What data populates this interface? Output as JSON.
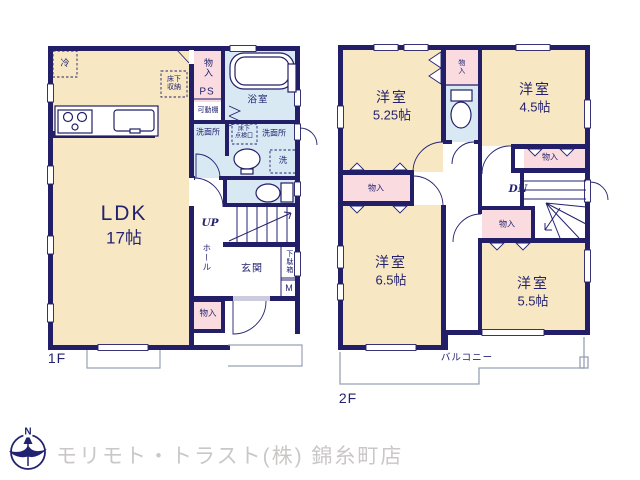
{
  "floor1": {
    "name": "1F",
    "ldk": "LDK",
    "ldk_size": "17帖",
    "fridge": "冷",
    "underfloor_storage": "床下\n収納",
    "closet_top": "物入",
    "ps": "PS",
    "movable_shelf": "可動棚",
    "bathroom": "浴室",
    "washroom_left": "洗面所",
    "underfloor_access": "床下\n点検口",
    "washroom_right": "洗面所",
    "laundry": "洗",
    "up": "UP",
    "hall": "ホール",
    "entrance": "玄関",
    "shoe_box": "下駄箱",
    "meter": "M",
    "closet_bottom": "物入"
  },
  "floor2": {
    "name": "2F",
    "room1": "洋室",
    "room1_size": "5.25帖",
    "room2": "洋室",
    "room2_size": "4.5帖",
    "room3": "洋室",
    "room3_size": "6.5帖",
    "room4": "洋室",
    "room4_size": "5.5帖",
    "closet_top": "物入",
    "closet_right": "物入",
    "closet_left": "物入",
    "closet_center": "物入",
    "dn": "DN",
    "balcony": "バルコニー"
  },
  "footer": {
    "company": "モリモト・トラスト(株) 錦糸町店",
    "north": "N"
  },
  "colors": {
    "wall_navy": "#221e68",
    "room_cream": "#f7e7c2",
    "closet_pink": "#f9dbe0",
    "wet_area_blue": "#d9e9f3",
    "outline_gray": "#98a0b4",
    "footer_gray": "#cac7c7"
  }
}
